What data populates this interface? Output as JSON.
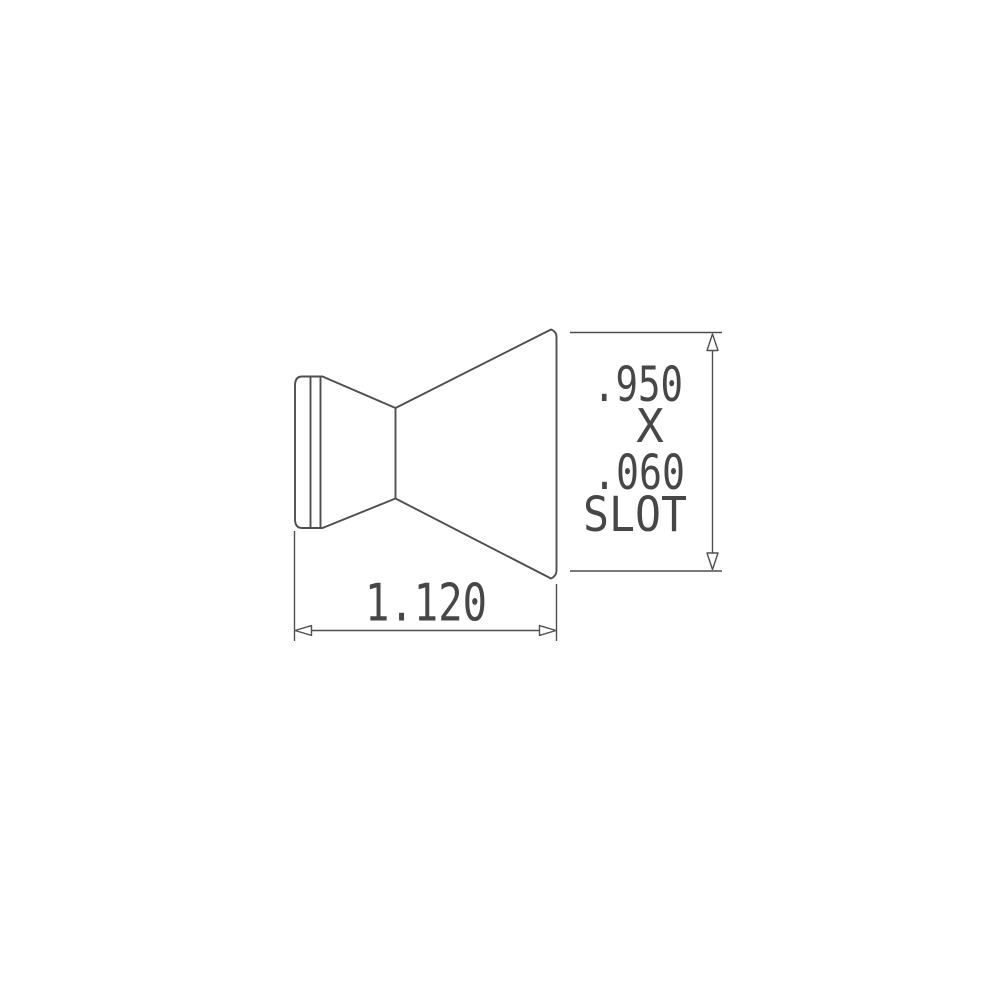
{
  "page": {
    "background_color": "#ffffff"
  },
  "drawing": {
    "stroke_color": "#4f4f4f",
    "text_color": "#474747",
    "arrow_fill_color": "#ffffff",
    "height_dimension": {
      "line1": ".950",
      "line2": "X",
      "line3": ".060",
      "line4": "SLOT"
    },
    "width_dimension": {
      "value": "1.120"
    }
  }
}
